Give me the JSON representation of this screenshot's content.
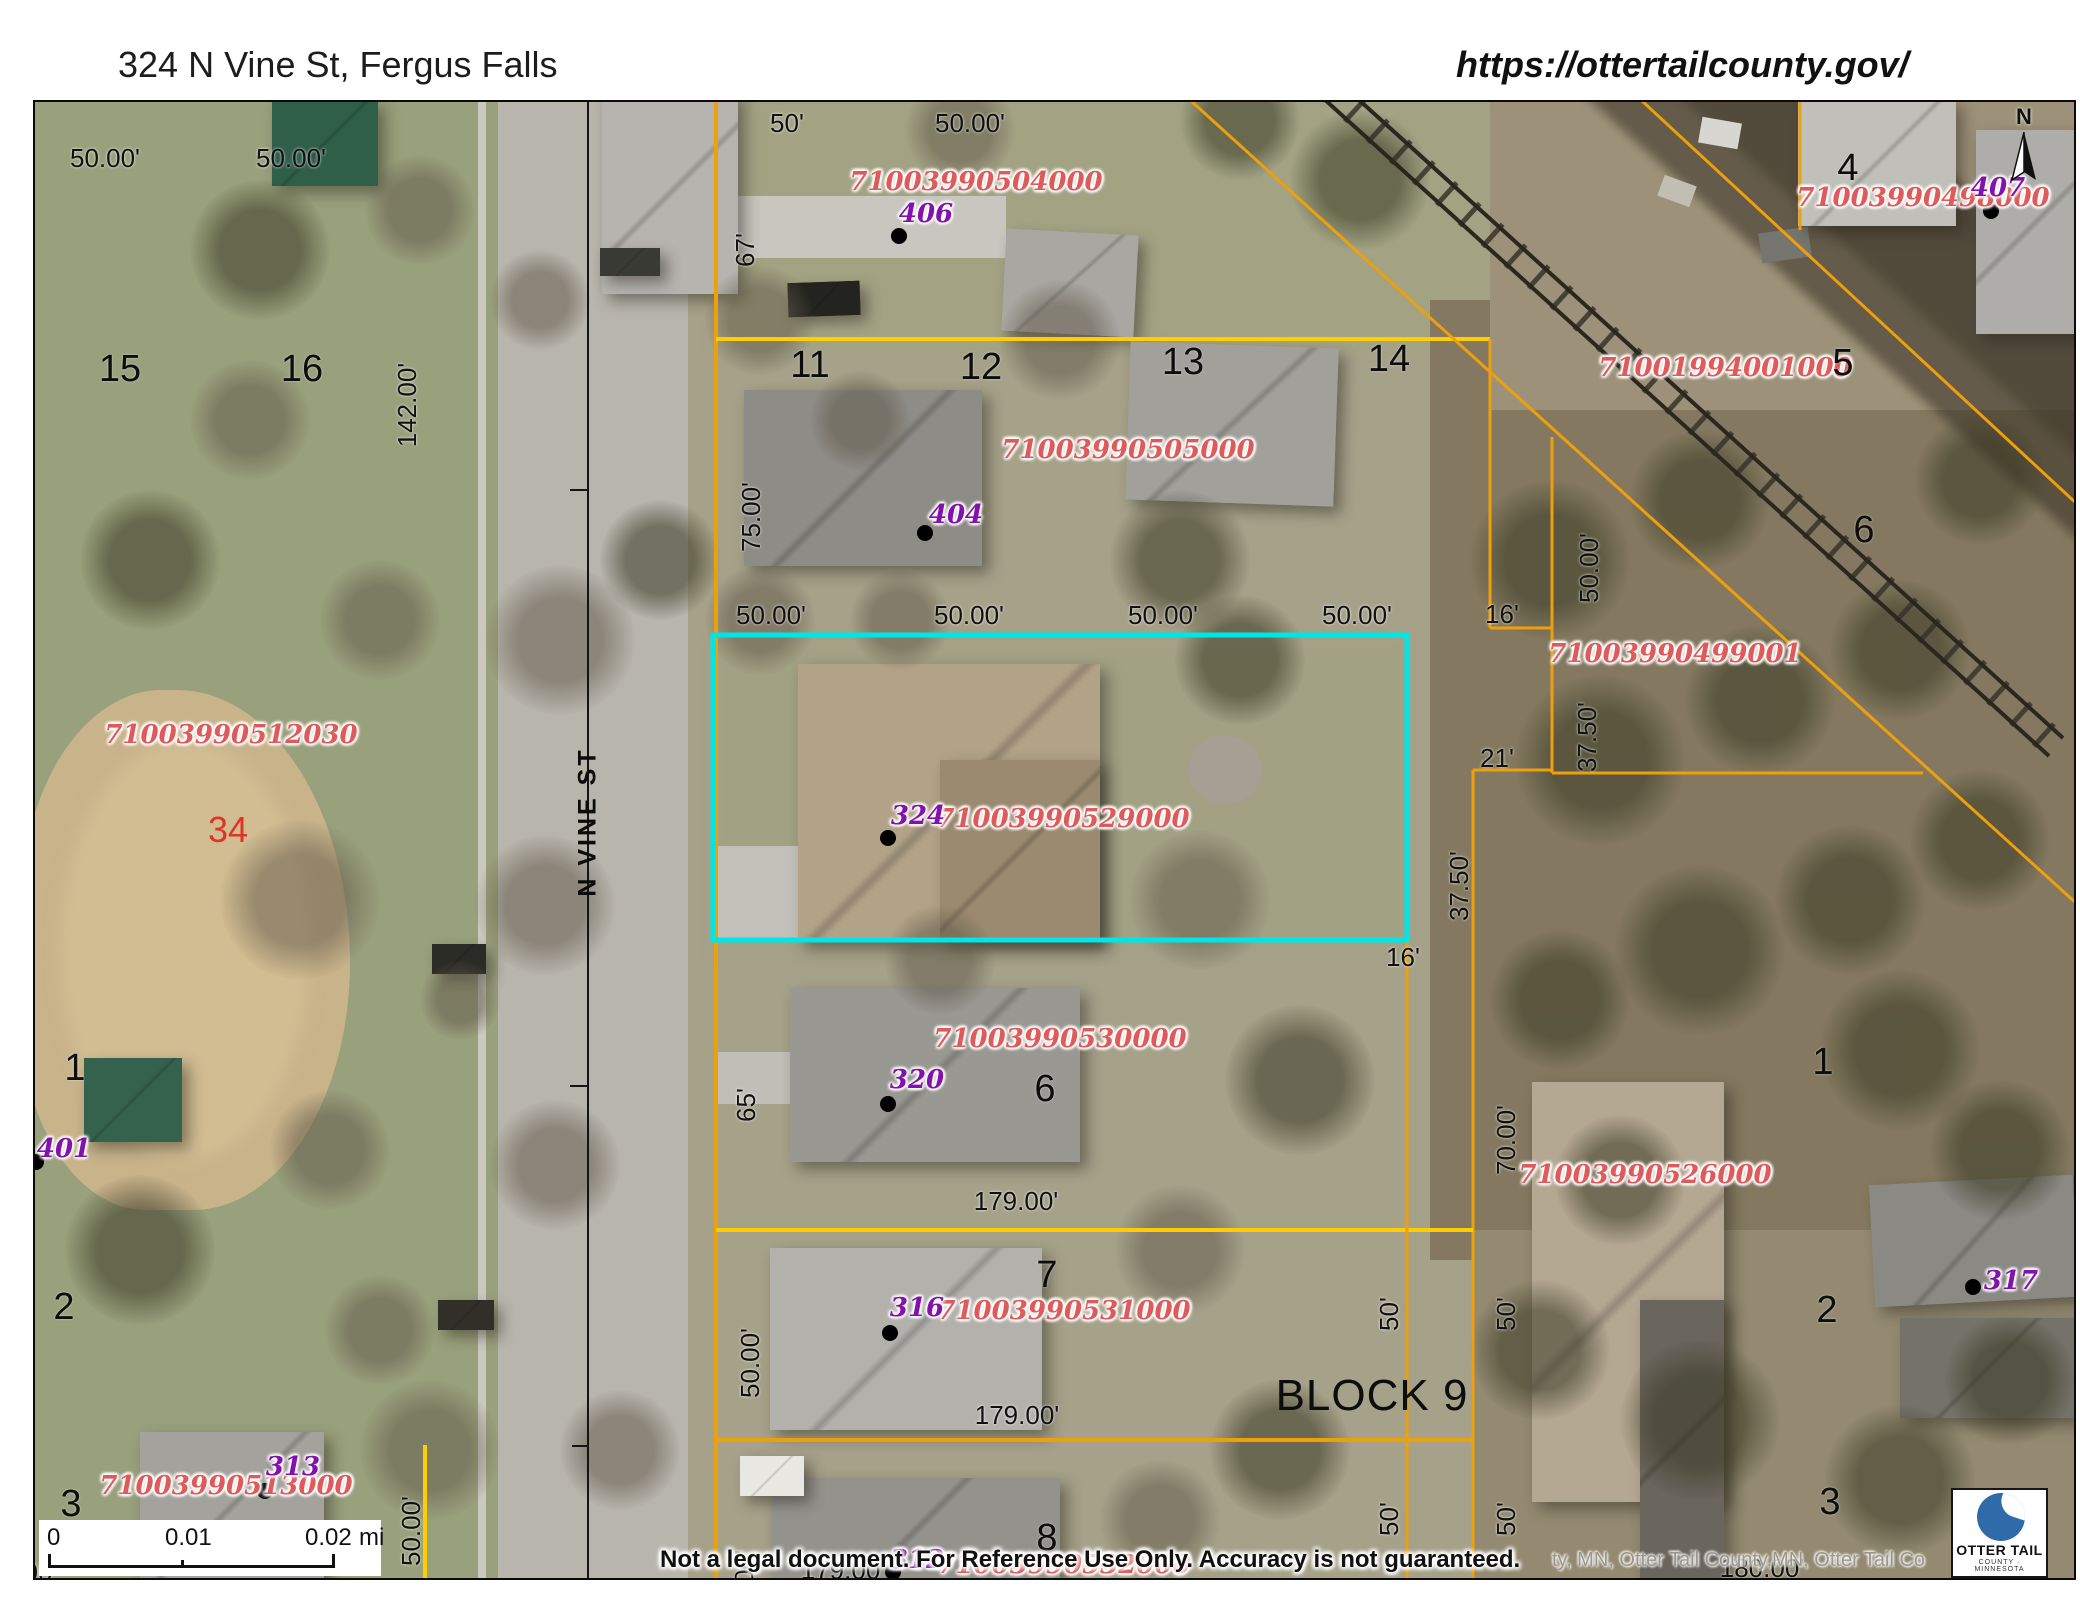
{
  "header": {
    "title": "324 N Vine St, Fergus Falls",
    "url": "https://ottertailcounty.gov/"
  },
  "map": {
    "disclaimer": "Not a legal document. For Reference Use Only.  Accuracy is not guaranteed.",
    "attribution": "ty, MN, Otter Tail County,MN, Otter Tail Co",
    "north_label": "N",
    "scale_bar": {
      "start": "0",
      "mid": "0.01",
      "end": "0.02",
      "unit": "mi"
    },
    "logo": {
      "line1": "OTTER TAIL",
      "line2": "COUNTY · MINNESOTA"
    },
    "colors": {
      "parcel_line": "#ee9f0c",
      "parcel_line_bright": "#ffce00",
      "highlight": "#00e6e6",
      "parcel_id": "#df5a5a",
      "address": "#8312ad",
      "street_line": "#141414",
      "dot": "#000000"
    },
    "highlight_parcel": {
      "x": 713,
      "y": 635,
      "w": 694,
      "h": 305
    },
    "lines": [
      [
        588,
        100,
        588,
        1580,
        "k",
        2
      ],
      [
        570,
        490,
        588,
        490,
        "k",
        2
      ],
      [
        570,
        1086,
        588,
        1086,
        "k",
        2
      ],
      [
        572,
        1446,
        588,
        1446,
        "k",
        2
      ],
      [
        716,
        100,
        716,
        1580,
        "o",
        4
      ],
      [
        716,
        339,
        1490,
        339,
        "b",
        4
      ],
      [
        1490,
        339,
        1490,
        628,
        "o",
        3
      ],
      [
        1490,
        628,
        1552,
        628,
        "o",
        3
      ],
      [
        1552,
        437,
        1552,
        773,
        "o",
        3
      ],
      [
        1473,
        770,
        1552,
        770,
        "o",
        3
      ],
      [
        1473,
        770,
        1473,
        1580,
        "o",
        3
      ],
      [
        1552,
        773,
        1923,
        773,
        "o",
        3
      ],
      [
        1190,
        100,
        2076,
        903,
        "o",
        3
      ],
      [
        1641,
        100,
        2076,
        503,
        "o",
        3
      ],
      [
        1800,
        100,
        1800,
        230,
        "o",
        3
      ],
      [
        425,
        1445,
        425,
        1580,
        "b",
        4
      ],
      [
        716,
        1230,
        1473,
        1230,
        "b",
        4
      ],
      [
        716,
        1440,
        1473,
        1440,
        "o",
        4
      ],
      [
        1407,
        940,
        1407,
        1580,
        "o",
        3
      ]
    ],
    "dots": [
      [
        899,
        236
      ],
      [
        925,
        533
      ],
      [
        888,
        838
      ],
      [
        888,
        1104
      ],
      [
        890,
        1333
      ],
      [
        893,
        1572
      ],
      [
        1991,
        211
      ],
      [
        36,
        1162
      ],
      [
        1973,
        1287
      ],
      [
        265,
        1491
      ]
    ],
    "labels": [
      [
        "71003990504000",
        976,
        182,
        "id"
      ],
      [
        "71003990505000",
        1128,
        450,
        "id"
      ],
      [
        "71003990529000",
        1063,
        819,
        "id"
      ],
      [
        "71003990530000",
        1060,
        1039,
        "id"
      ],
      [
        "71003990531000",
        1064,
        1311,
        "id"
      ],
      [
        "71003990532000",
        1064,
        1565,
        "id"
      ],
      [
        "71003990512030",
        231,
        735,
        "id"
      ],
      [
        "71001994001000",
        1725,
        368,
        "id"
      ],
      [
        "71003990498000",
        1923,
        198,
        "id"
      ],
      [
        "71003990499001",
        1675,
        654,
        "id"
      ],
      [
        "71003990526000",
        1645,
        1175,
        "id"
      ],
      [
        "71003990513000",
        226,
        1486,
        "id"
      ],
      [
        "406",
        926,
        214,
        "addr"
      ],
      [
        "404",
        956,
        515,
        "addr"
      ],
      [
        "324",
        918,
        816,
        "addr"
      ],
      [
        "320",
        917,
        1080,
        "addr"
      ],
      [
        "316",
        917,
        1308,
        "addr"
      ],
      [
        "312",
        917,
        1560,
        "addr"
      ],
      [
        "407",
        1998,
        188,
        "addr"
      ],
      [
        "401",
        64,
        1149,
        "addr"
      ],
      [
        "317",
        2011,
        1281,
        "addr"
      ],
      [
        "313",
        293,
        1467,
        "addr"
      ],
      [
        "15",
        120,
        369,
        "lot"
      ],
      [
        "16",
        302,
        369,
        "lot"
      ],
      [
        "11",
        810,
        365,
        "lot"
      ],
      [
        "12",
        981,
        367,
        "lot"
      ],
      [
        "13",
        1183,
        362,
        "lot"
      ],
      [
        "14",
        1389,
        359,
        "lot"
      ],
      [
        "4",
        1848,
        168,
        "lot"
      ],
      [
        "5",
        1843,
        363,
        "lot"
      ],
      [
        "6",
        1864,
        530,
        "lot"
      ],
      [
        "6",
        1045,
        1089,
        "lot"
      ],
      [
        "7",
        1047,
        1275,
        "lot"
      ],
      [
        "8",
        1047,
        1538,
        "lot"
      ],
      [
        "1",
        75,
        1068,
        "lot"
      ],
      [
        "2",
        64,
        1307,
        "lot"
      ],
      [
        "3",
        71,
        1504,
        "lot"
      ],
      [
        "1",
        1823,
        1062,
        "lot"
      ],
      [
        "2",
        1827,
        1310,
        "lot"
      ],
      [
        "3",
        1830,
        1502,
        "lot"
      ],
      [
        "34",
        228,
        830,
        "red"
      ],
      [
        "BLOCK 9",
        1372,
        1396,
        "block"
      ],
      [
        "N VINE ST",
        588,
        822,
        "street",
        "v"
      ],
      [
        "50.00'",
        105,
        158,
        "dim"
      ],
      [
        "50.00'",
        291,
        158,
        "dim"
      ],
      [
        "50'",
        787,
        123,
        "dim"
      ],
      [
        "50.00'",
        970,
        123,
        "dim"
      ],
      [
        "50.00'",
        771,
        615,
        "dim"
      ],
      [
        "50.00'",
        969,
        615,
        "dim"
      ],
      [
        "50.00'",
        1163,
        615,
        "dim"
      ],
      [
        "50.00'",
        1357,
        615,
        "dim"
      ],
      [
        "16'",
        1502,
        614,
        "dim"
      ],
      [
        "16'",
        1403,
        957,
        "dim"
      ],
      [
        "21'",
        1497,
        758,
        "dim"
      ],
      [
        "179.00'",
        1016,
        1201,
        "dim"
      ],
      [
        "179.00'",
        1017,
        1415,
        "dim"
      ],
      [
        "00'",
        16,
        1376,
        "dim"
      ],
      [
        "00",
        38,
        1572,
        "dim"
      ],
      [
        "67'",
        745,
        250,
        "dim",
        "v"
      ],
      [
        "142.00'",
        407,
        405,
        "dim",
        "v"
      ],
      [
        "75.00'",
        751,
        517,
        "dim",
        "v"
      ],
      [
        "50.00'",
        1589,
        568,
        "dim",
        "v"
      ],
      [
        "37.50'",
        1587,
        737,
        "dim",
        "v"
      ],
      [
        "37.50'",
        1459,
        886,
        "dim",
        "v"
      ],
      [
        "70.00'",
        1506,
        1140,
        "dim",
        "v"
      ],
      [
        "65'",
        746,
        1105,
        "dim",
        "v"
      ],
      [
        "50.00'",
        750,
        1363,
        "dim",
        "v"
      ],
      [
        "50'",
        1389,
        1314,
        "dim",
        "v"
      ],
      [
        "50'",
        1506,
        1314,
        "dim",
        "v"
      ],
      [
        "50'",
        1389,
        1519,
        "dim",
        "v"
      ],
      [
        "50'",
        1506,
        1519,
        "dim",
        "v"
      ],
      [
        "00'",
        744,
        1567,
        "dim",
        "v"
      ],
      [
        "50.00'",
        411,
        1531,
        "dim",
        "v"
      ],
      [
        "179.00'",
        843,
        1570,
        "under"
      ],
      [
        "180.00'",
        1762,
        1568,
        "under"
      ]
    ]
  }
}
